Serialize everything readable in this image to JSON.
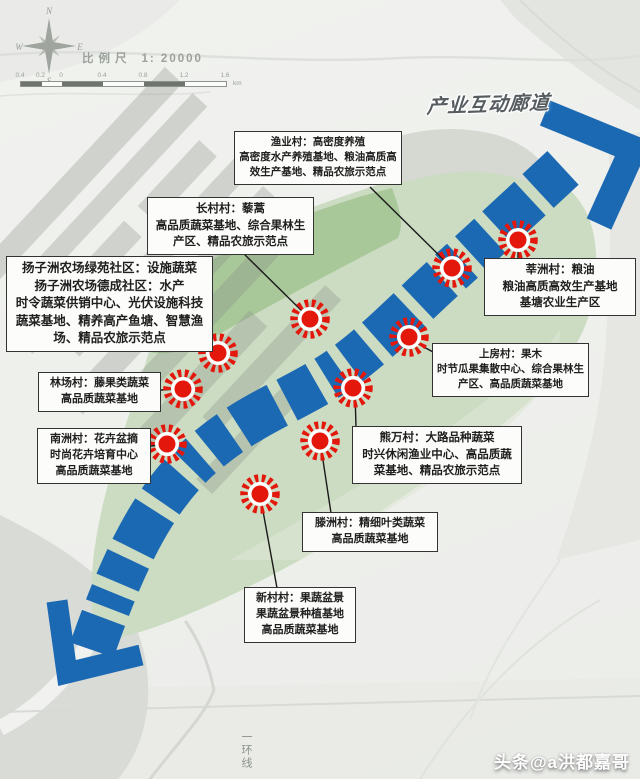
{
  "compass": {
    "n": "N",
    "e": "E",
    "s": "S",
    "w": "W"
  },
  "legend": {
    "scale_label": "比例尺",
    "scale_ratio": "1: 20000",
    "bar_labels": [
      "0.4",
      "0.2",
      "0",
      "0.4",
      "0.8",
      "1.2",
      "1.6"
    ],
    "bar_unit": "km"
  },
  "map": {
    "corridor_label": "产业互动廊道",
    "ring_road_label": "一环线",
    "villages": [
      {
        "id": "yuye",
        "lines": [
          "渔业村：高密度养殖",
          "高密度水产养殖基地、粮油高质高",
          "效生产基地、精品农旅示范点"
        ]
      },
      {
        "id": "changcun",
        "lines": [
          "长村村：藜蒿",
          "高品质蔬菜基地、综合果林生",
          "产区、精品农旅示范点"
        ]
      },
      {
        "id": "yangzizhou",
        "lines": [
          "扬子洲农场绿苑社区：设施蔬菜",
          "扬子洲农场德成社区：水产",
          "时令蔬菜供销中心、光伏设施科技",
          "蔬菜基地、精养高产鱼塘、智慧渔",
          "场、精品农旅示范点"
        ]
      },
      {
        "id": "shenzhou",
        "lines": [
          "莘洲村：粮油",
          "粮油高质高效生产基地",
          "基塘农业生产区"
        ]
      },
      {
        "id": "shangfang",
        "lines": [
          "上房村：果木",
          "时节瓜果集散中心、综合果林生",
          "产区、高品质蔬菜基地"
        ]
      },
      {
        "id": "linchang",
        "lines": [
          "林场村：藤果类蔬菜",
          "高品质蔬菜基地"
        ]
      },
      {
        "id": "xiongwan",
        "lines": [
          "熊万村：大路品种蔬菜",
          "时兴休闲渔业中心、高品质蔬",
          "菜基地、精品农旅示范点"
        ]
      },
      {
        "id": "nanzhou",
        "lines": [
          "南洲村：花卉盆摘",
          "时尚花卉培育中心",
          "高品质蔬菜基地"
        ]
      },
      {
        "id": "tengzhou",
        "lines": [
          "滕洲村：精细叶类蔬菜",
          "高品质蔬菜基地"
        ]
      },
      {
        "id": "xincun",
        "lines": [
          "新村村：果蔬盆景",
          "果蔬盆景种植基地",
          "高品质蔬菜基地"
        ]
      }
    ],
    "markers": [
      {
        "village": "yuye",
        "x": 452,
        "y": 268
      },
      {
        "village": "changcun",
        "x": 310,
        "y": 319
      },
      {
        "village": "yangzizhou",
        "x": 218,
        "y": 353
      },
      {
        "village": "shenzhou",
        "x": 518,
        "y": 240
      },
      {
        "village": "shangfang",
        "x": 409,
        "y": 337
      },
      {
        "village": "linchang",
        "x": 183,
        "y": 389
      },
      {
        "village": "xiongwan",
        "x": 353,
        "y": 388
      },
      {
        "village": "nanzhou",
        "x": 167,
        "y": 444
      },
      {
        "village": "tengzhou",
        "x": 320,
        "y": 441
      },
      {
        "village": "xincun",
        "x": 260,
        "y": 494
      }
    ]
  },
  "colors": {
    "corridor_blue": "#1c69b3",
    "marker_red": "#e3170c",
    "island_green": "#cbdcc2",
    "island_green_dark": "#a6c697",
    "label_border": "#333333"
  },
  "footer": {
    "watermark": "头条@a洪都嘉哥"
  }
}
